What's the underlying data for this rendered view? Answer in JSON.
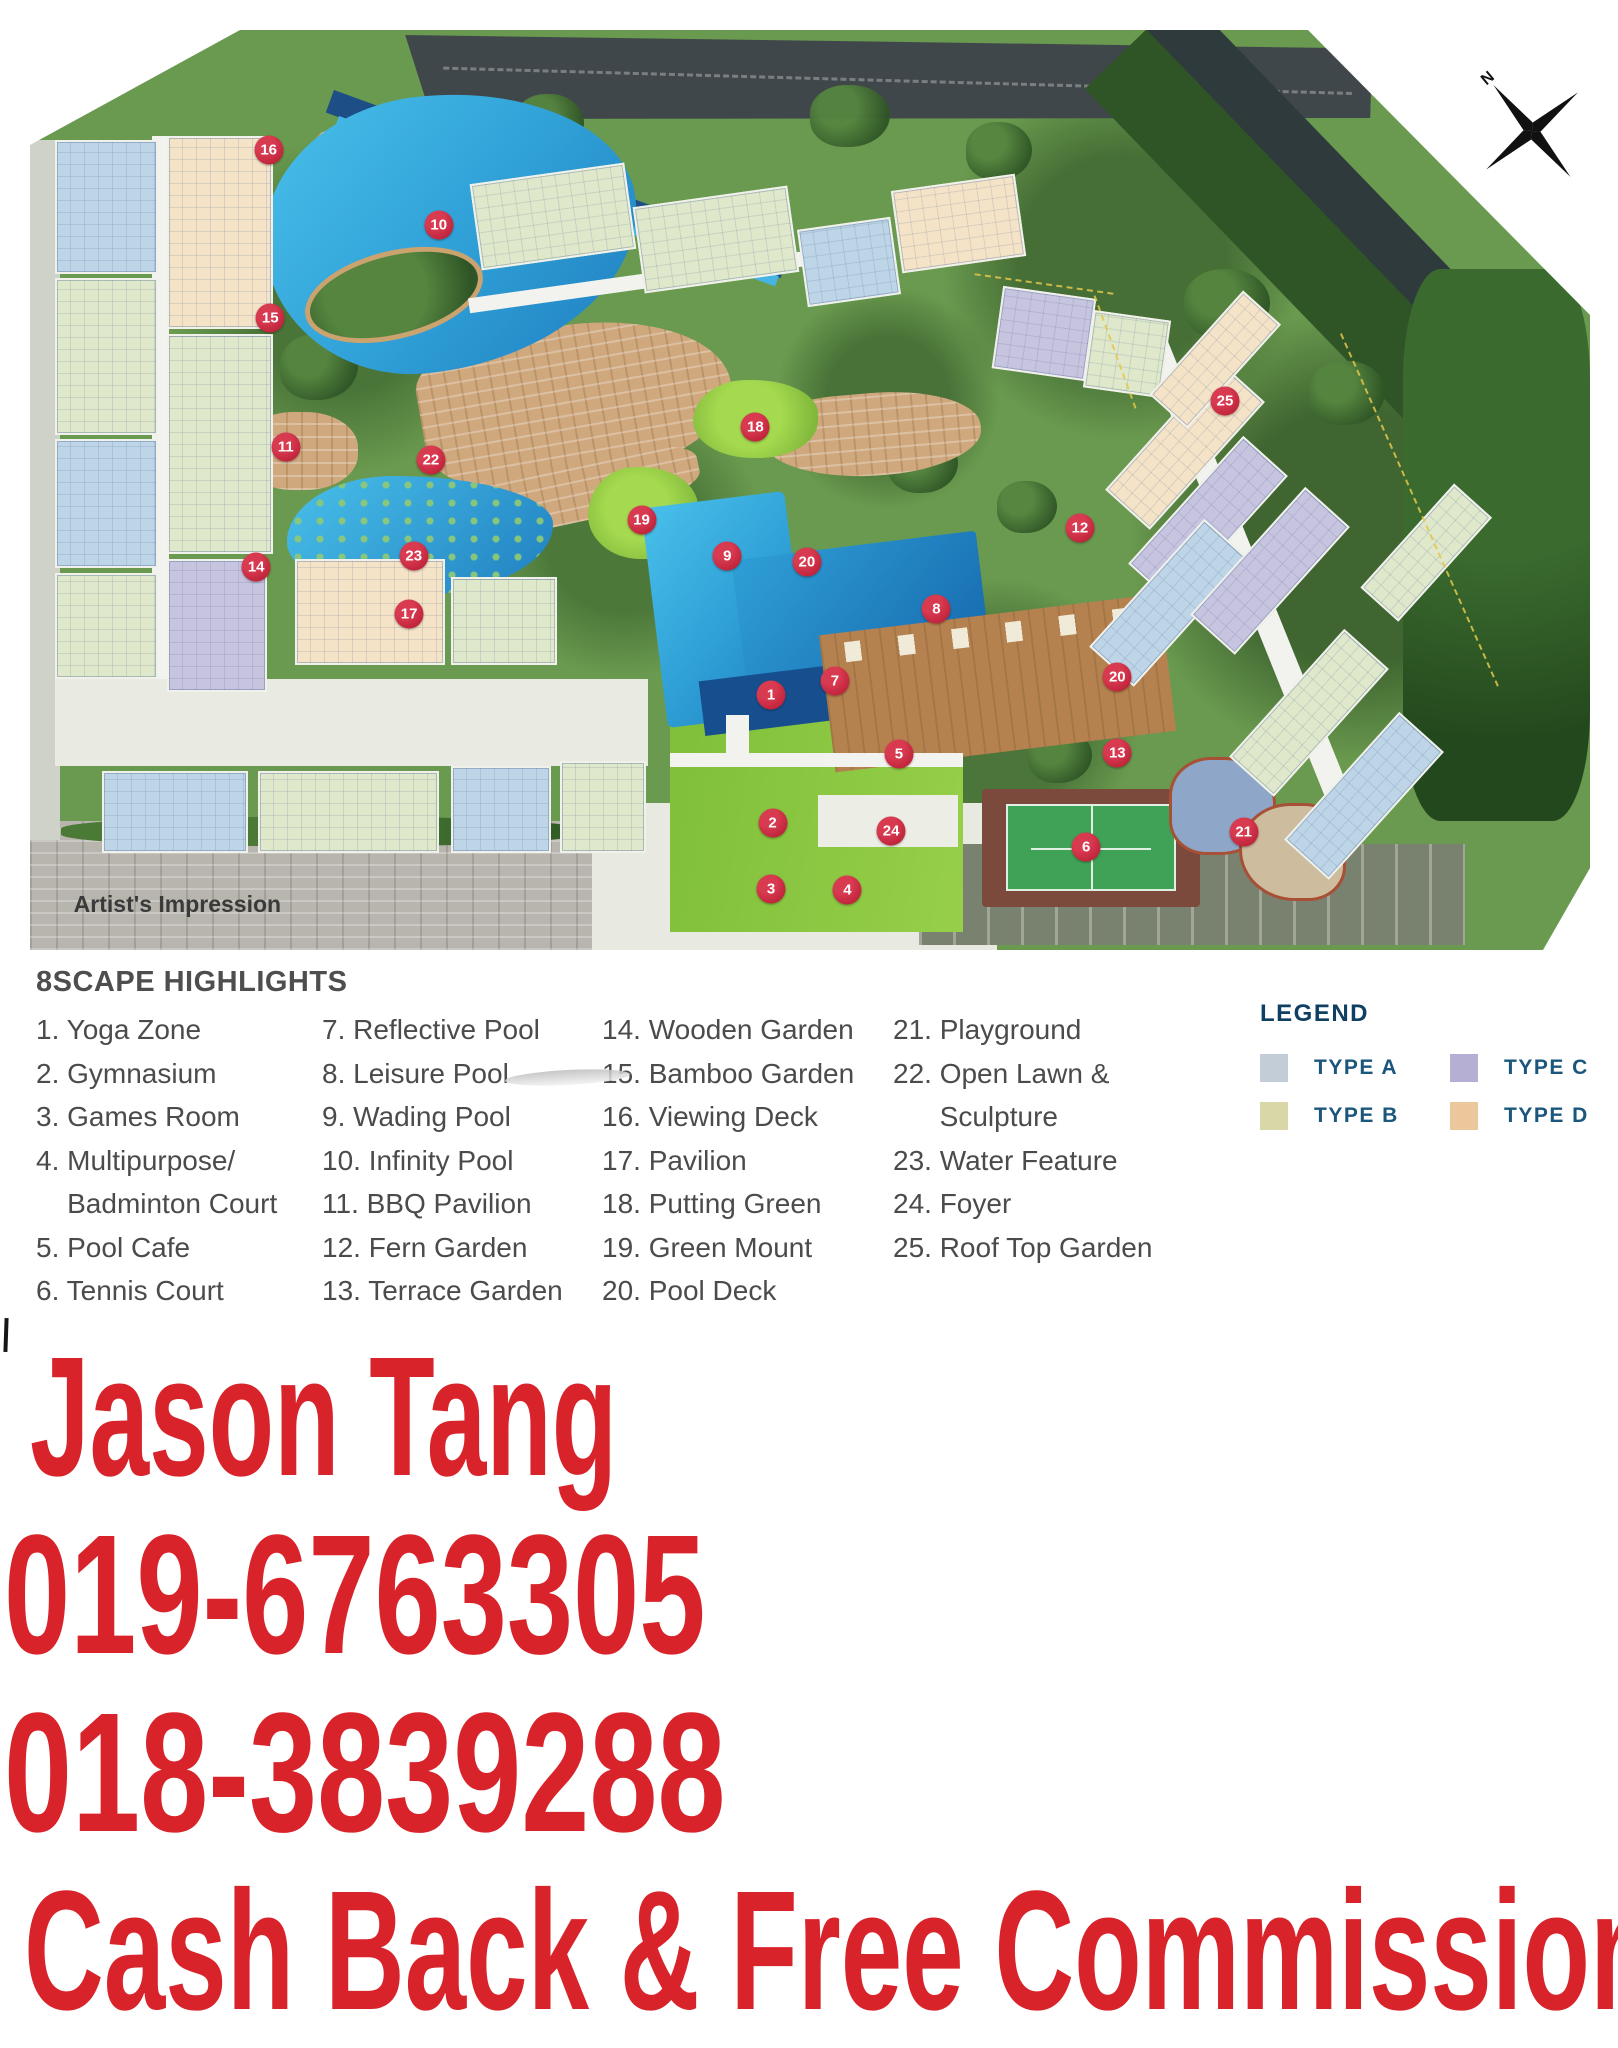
{
  "map": {
    "caption": "Artist's Impression",
    "compass_label": "N",
    "markers": [
      {
        "n": "16",
        "x": 15.3,
        "y": 13.0
      },
      {
        "n": "10",
        "x": 26.2,
        "y": 21.2
      },
      {
        "n": "15",
        "x": 15.4,
        "y": 31.3
      },
      {
        "n": "11",
        "x": 16.4,
        "y": 45.3
      },
      {
        "n": "22",
        "x": 25.7,
        "y": 46.7
      },
      {
        "n": "18",
        "x": 46.5,
        "y": 43.2
      },
      {
        "n": "25",
        "x": 76.6,
        "y": 40.3
      },
      {
        "n": "12",
        "x": 67.3,
        "y": 54.1
      },
      {
        "n": "19",
        "x": 39.2,
        "y": 53.3
      },
      {
        "n": "9",
        "x": 44.7,
        "y": 57.2
      },
      {
        "n": "20",
        "x": 49.8,
        "y": 57.8
      },
      {
        "n": "23",
        "x": 24.6,
        "y": 57.2
      },
      {
        "n": "14",
        "x": 14.5,
        "y": 58.4
      },
      {
        "n": "17",
        "x": 24.3,
        "y": 63.5
      },
      {
        "n": "8",
        "x": 58.1,
        "y": 62.9
      },
      {
        "n": "7",
        "x": 51.6,
        "y": 70.8
      },
      {
        "n": "1",
        "x": 47.5,
        "y": 72.3
      },
      {
        "n": "20",
        "x": 69.7,
        "y": 70.3
      },
      {
        "n": "5",
        "x": 55.7,
        "y": 78.7
      },
      {
        "n": "13",
        "x": 69.7,
        "y": 78.6
      },
      {
        "n": "2",
        "x": 47.6,
        "y": 86.2
      },
      {
        "n": "24",
        "x": 55.2,
        "y": 87.1
      },
      {
        "n": "6",
        "x": 67.7,
        "y": 88.8
      },
      {
        "n": "21",
        "x": 77.8,
        "y": 87.2
      },
      {
        "n": "3",
        "x": 47.5,
        "y": 93.4
      },
      {
        "n": "4",
        "x": 52.4,
        "y": 93.5
      }
    ]
  },
  "highlights": {
    "title": "8SCAPE HIGHLIGHTS",
    "columns": [
      [
        "1. Yoga Zone",
        "2. Gymnasium",
        "3. Games Room",
        "4. Multipurpose/",
        "    Badminton Court",
        "5. Pool Cafe",
        "6. Tennis Court"
      ],
      [
        "7. Reflective Pool",
        "8. Leisure Pool",
        "9. Wading Pool",
        "10. Infinity Pool",
        "11. BBQ Pavilion",
        "12. Fern Garden",
        "13. Terrace Garden"
      ],
      [
        "14. Wooden Garden",
        "15. Bamboo Garden",
        "16. Viewing Deck",
        "17. Pavilion",
        "18. Putting Green",
        "19. Green Mount",
        "20. Pool Deck"
      ],
      [
        "21. Playground",
        "22. Open Lawn &",
        "      Sculpture",
        "23. Water Feature",
        "24. Foyer",
        "25. Roof Top Garden"
      ]
    ]
  },
  "legend": {
    "title": "LEGEND",
    "items": [
      {
        "label": "TYPE A",
        "color": "#c3cdd8"
      },
      {
        "label": "TYPE C",
        "color": "#b5b0d3"
      },
      {
        "label": "TYPE B",
        "color": "#d9d6a8"
      },
      {
        "label": "TYPE D",
        "color": "#ecc79c"
      }
    ]
  },
  "contact": {
    "agent_name": "Jason Tang",
    "phone_1": "019-6763305",
    "phone_2": "018-3839288",
    "tagline": "Cash Back & Free Commission",
    "text_color": "#d9232b"
  }
}
